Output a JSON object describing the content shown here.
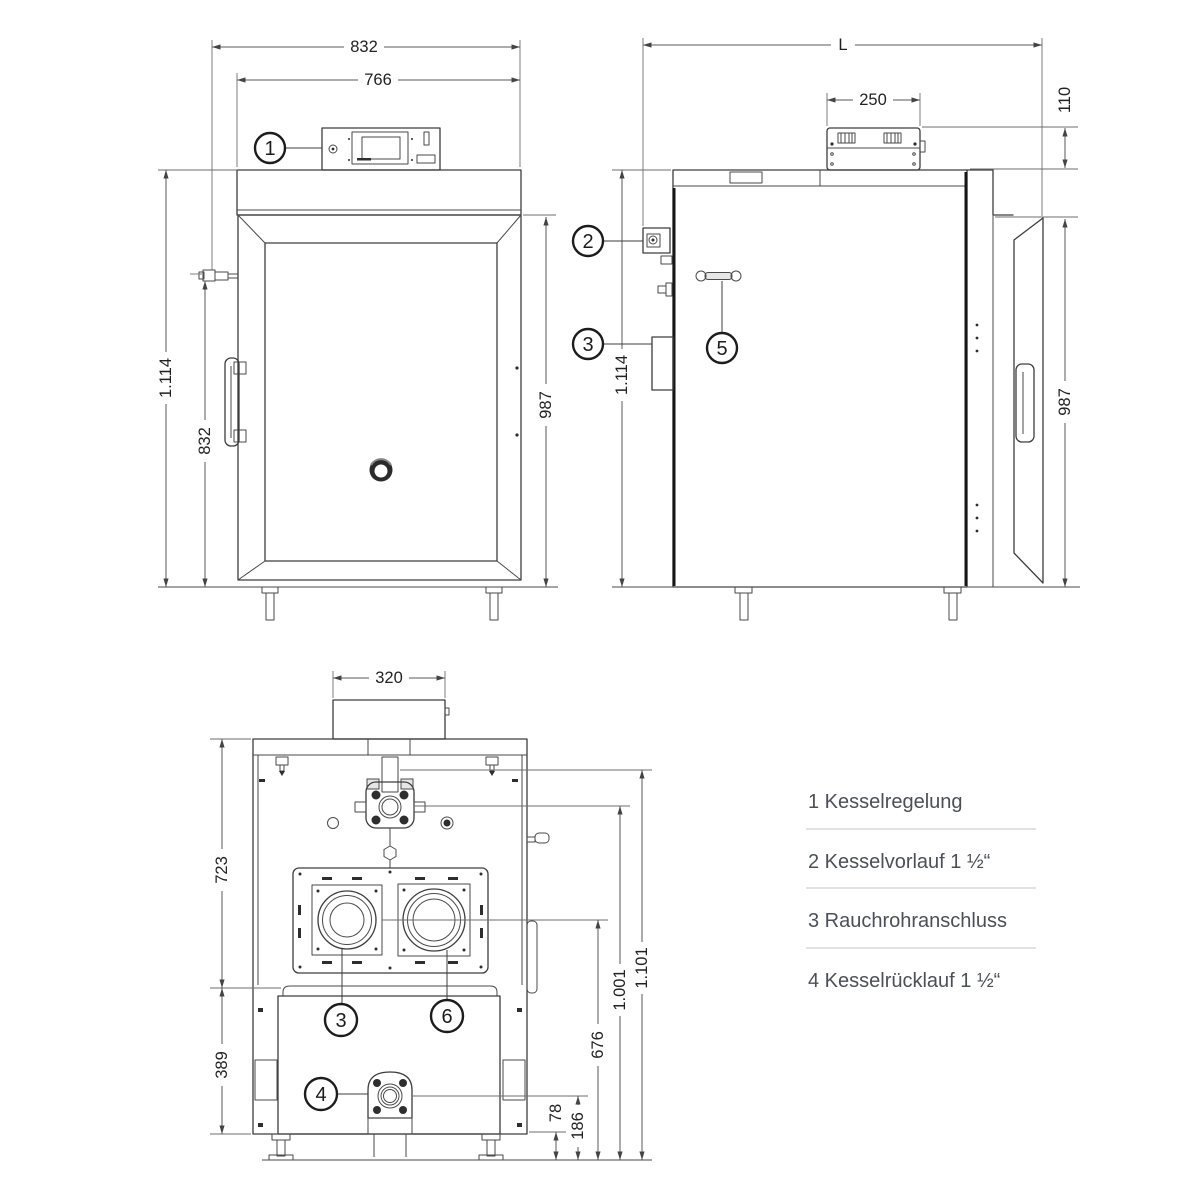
{
  "dims": {
    "front_width_outer": "832",
    "front_width_inner": "766",
    "front_height_total": "1.114",
    "front_height_fitting": "832",
    "front_height_body": "987",
    "side_length": "L",
    "side_panel_width": "250",
    "side_panel_height": "110",
    "side_height_total": "1.114",
    "side_height_body": "987",
    "rear_flue_width": "320",
    "rear_upper_height": "723",
    "rear_lower_height": "389",
    "rear_flue_center_height": "676",
    "rear_return_center_height": "186",
    "rear_base_height": "78",
    "rear_flow_center_height": "1.001",
    "rear_flow_top_height": "1.101"
  },
  "callouts": {
    "n1": "1",
    "n2": "2",
    "n3": "3",
    "n4": "4",
    "n5": "5",
    "n6": "6"
  },
  "legend": {
    "items": [
      {
        "text": "1 Kesselregelung"
      },
      {
        "text": "2 Kesselvorlauf 1 ½“"
      },
      {
        "text": "3 Rauchrohranschluss"
      },
      {
        "text": "4 Kesselrücklauf 1 ½“"
      }
    ]
  }
}
